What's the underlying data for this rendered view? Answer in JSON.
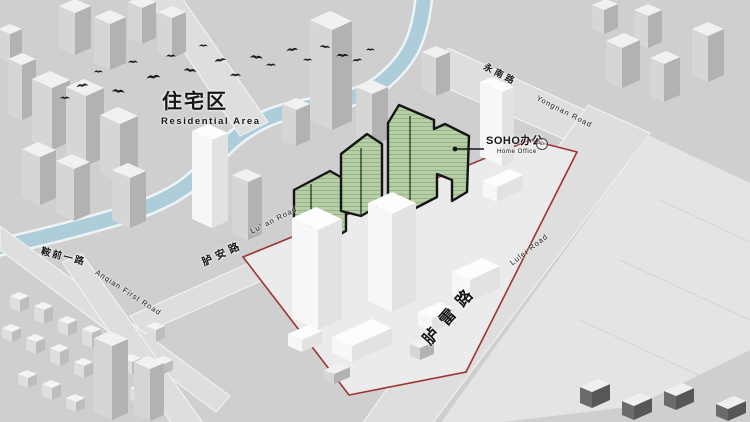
{
  "canvas": {
    "width": 750,
    "height": 422
  },
  "colors": {
    "background": "#cfcfcf",
    "road": "#dedede",
    "road_edge": "#f5f5f5",
    "river": "#aecddb",
    "river_bank": "#eef4f6",
    "plaza": "#e4e4e4",
    "plaza_line": "#d4d4d4",
    "parcel": "#ebebeb",
    "boundary_red": "#9c3431",
    "highlight_green": "#b7d0a7",
    "highlight_green_stripe": "#96b487",
    "outline_black": "#151515",
    "bird": "#1c1c1c",
    "text": "#161616"
  },
  "labels": {
    "residential": {
      "zh": "住宅区",
      "en": "Residential Area"
    },
    "soho": {
      "zh": "SOHO办公",
      "en": "Home Office",
      "badge_glyph": "⌂"
    },
    "roads": {
      "yongnan": {
        "zh": "永南路",
        "en": "Yongnan Road"
      },
      "lulei": {
        "zh": "胪雷路",
        "en": "Lulei Road"
      },
      "luan": {
        "zh": "胪安路",
        "en": "Lu' an Road"
      },
      "anqian": {
        "zh": "鞍前一路",
        "en": "Anqian First Road"
      }
    }
  }
}
